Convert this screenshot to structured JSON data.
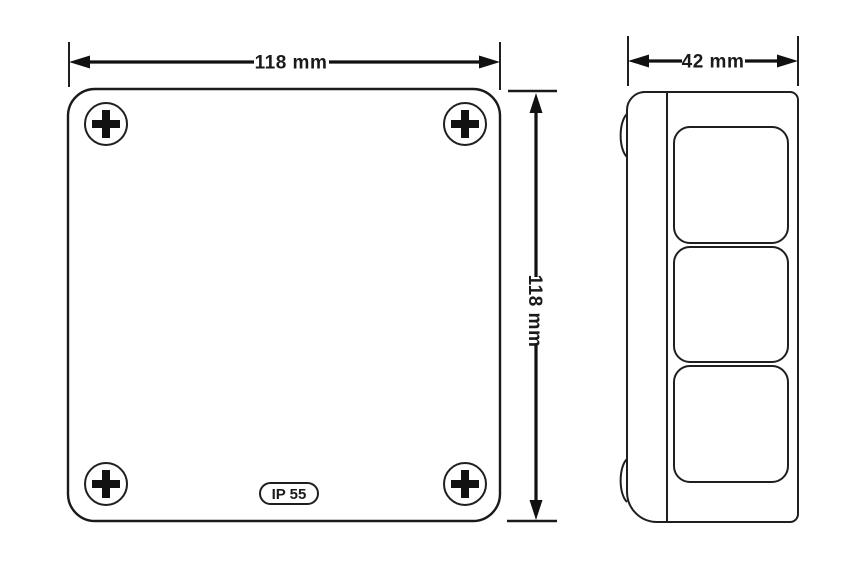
{
  "drawing": {
    "colors": {
      "line": "#1a1a1a",
      "background": "#ffffff"
    },
    "front_view": {
      "dim_width_label": "118 mm",
      "dim_height_label": "118 mm",
      "rating_badge_label": "IP 55",
      "screw_count": 4
    },
    "side_view": {
      "dim_depth_label": "42 mm",
      "knockout_count": 3
    }
  }
}
